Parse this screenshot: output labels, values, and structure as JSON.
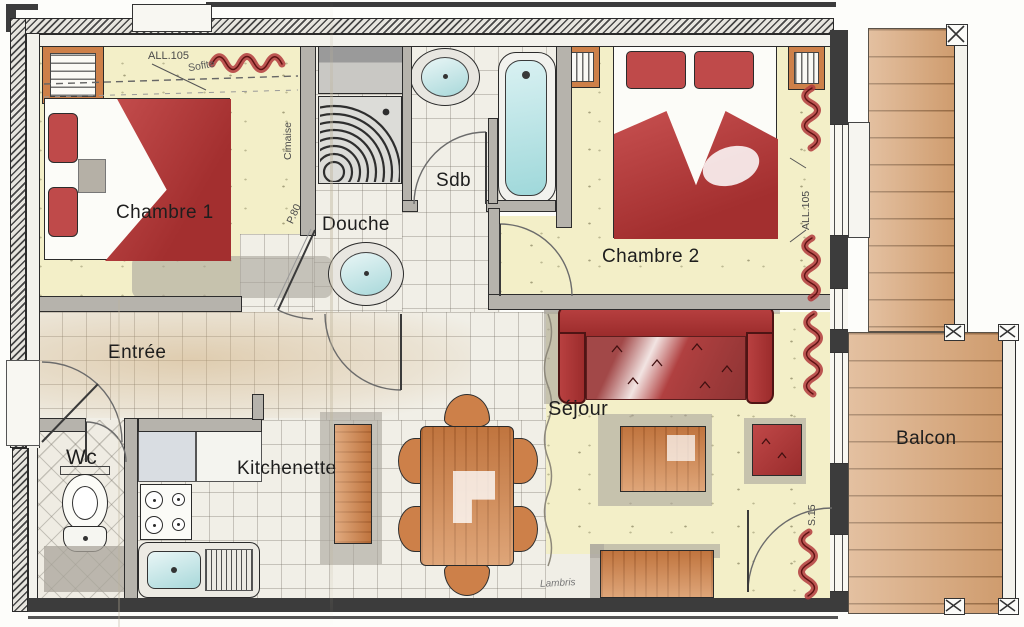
{
  "document_title": "Apartment floor plan (hand-coloured)",
  "rooms": {
    "chambre1": {
      "label": "Chambre 1"
    },
    "chambre2": {
      "label": "Chambre 2"
    },
    "douche": {
      "label": "Douche"
    },
    "sdb": {
      "label": "Sdb"
    },
    "entree": {
      "label": "Entrée"
    },
    "wc": {
      "label": "Wc"
    },
    "kitchenette": {
      "label": "Kitchenette"
    },
    "sejour": {
      "label": "Séjour"
    },
    "balcon": {
      "label": "Balcon"
    }
  },
  "annotations": {
    "all105_top": "ALL.105",
    "sofite": "Sofite",
    "cimaise": "Cimaise",
    "p80": "P.80",
    "all105_right": "ALL.105",
    "s15": "S.15",
    "lambris": "Lambris"
  },
  "fixtures": [
    "double-bed",
    "wardrobe",
    "shower-tray",
    "washbasin",
    "bathtub",
    "toilet",
    "stove",
    "kitchen-sink",
    "dining-table",
    "chair",
    "sofa",
    "coffee-table",
    "pouf",
    "sideboard",
    "kitchen-bar",
    "curtain",
    "balcony-post"
  ],
  "colors": {
    "bedding_red": "#b03c3c",
    "furniture_orange": "#cd8049",
    "balcony_wood": "#d9a87c",
    "water_blue": "#bfe4e4",
    "floor_yellow": "#f3efc8",
    "curtain_red": "#b23a3c",
    "wall_dark": "#3c3c3c"
  }
}
